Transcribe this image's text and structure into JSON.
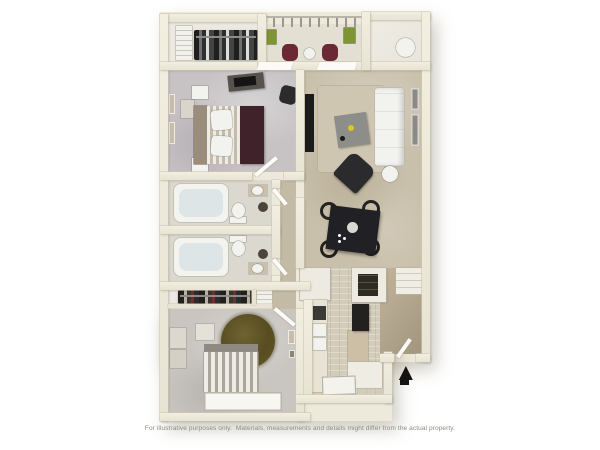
{
  "caption": {
    "text": "For illustrative purposes only.  Materials, measurements and details might differ from the actual property."
  },
  "floorplan": {
    "type": "3d-top-down-apartment-floor-plan",
    "entry_arrow_icon": "▲",
    "rooms": [
      "walk-in-closet",
      "balcony",
      "storage-room",
      "master-bedroom",
      "living-room",
      "dining-area",
      "hallway",
      "bathroom-1",
      "bathroom-2",
      "bedroom-2-closet",
      "bedroom-2",
      "kitchen",
      "entry-vestibule"
    ],
    "furniture": [
      "hanging-clothes",
      "patio-chairs",
      "planters",
      "water-heater",
      "bed",
      "nightstands",
      "dresser-tv",
      "tv-console",
      "area-rug",
      "sofa",
      "coffee-table",
      "armchair",
      "side-table",
      "wall-art",
      "dining-table",
      "dining-chairs",
      "bathtubs",
      "toilets",
      "sinks",
      "round-shag-rug",
      "striped-bed",
      "white-rug",
      "refrigerator",
      "counters",
      "stove",
      "kitchen-mat",
      "coat-closet",
      "front-door"
    ],
    "palette": {
      "background": "#ffffff",
      "wall": "#e8e4d4",
      "wall_edge": "#cfc9b2",
      "wall_light": "#eeeadb",
      "bedroom_carpet": "#c7c3c5",
      "bedroom2_carpet": "#c9c6c1",
      "living_floor": "#c9c0ab",
      "hall_floor": "#c4bba6",
      "bath_floor": "#dbd8d0",
      "closet_floor": "#ebe9e1",
      "balcony_floor": "#e3dfd2",
      "storage_floor": "#e8e5dc",
      "kitchen_tile": "#d4ccba",
      "entry_floor": "#b4a78f",
      "rug_round": "#5e5325",
      "bed_blanket": "#40222a",
      "accent_maroon": "#6d2836",
      "plant_green": "#7f9434",
      "furniture_dark": "#2b2b2d",
      "sofa_white": "#f2f2ef",
      "coffee_table": "#8d8d89",
      "coffee_accent_yellow": "#d9c81f",
      "caption_text": "#8b8b85",
      "arrow_black": "#131313"
    }
  }
}
